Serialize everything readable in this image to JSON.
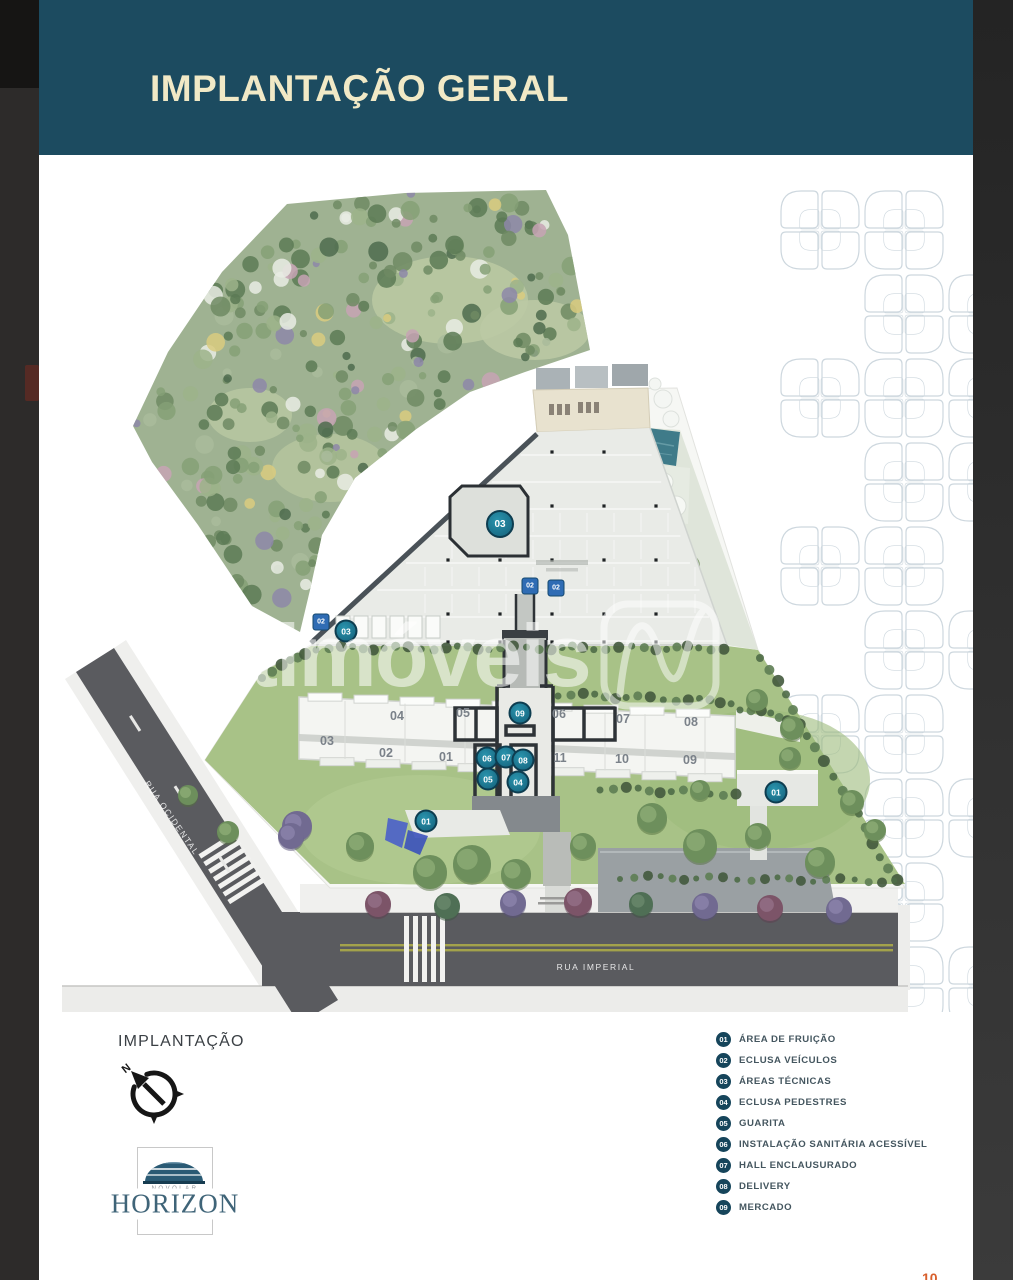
{
  "header": {
    "title": "IMPLANTAÇÃO GERAL"
  },
  "watermark": {
    "text": "netimóveis",
    "logo_icon": "netimoveis-n-mark"
  },
  "plan": {
    "streets": [
      {
        "name": "RUA OCIDENTAL",
        "x": 172,
        "y": 818,
        "angle": 55
      },
      {
        "name": "RUA IMPERIAL",
        "x": 596,
        "y": 967,
        "angle": 0
      }
    ],
    "building_units": [
      {
        "label": "04",
        "x": 397,
        "y": 716
      },
      {
        "label": "05",
        "x": 463,
        "y": 713
      },
      {
        "label": "06",
        "x": 559,
        "y": 714
      },
      {
        "label": "07",
        "x": 623,
        "y": 719
      },
      {
        "label": "08",
        "x": 691,
        "y": 722
      },
      {
        "label": "03",
        "x": 327,
        "y": 741
      },
      {
        "label": "02",
        "x": 386,
        "y": 753
      },
      {
        "label": "01",
        "x": 446,
        "y": 757
      },
      {
        "label": "11",
        "x": 560,
        "y": 758
      },
      {
        "label": "10",
        "x": 622,
        "y": 759
      },
      {
        "label": "09",
        "x": 690,
        "y": 760
      }
    ],
    "markers": [
      {
        "num": "02",
        "x": 321,
        "y": 622,
        "shape": "square"
      },
      {
        "num": "03",
        "x": 346,
        "y": 631,
        "shape": "circle"
      },
      {
        "num": "03",
        "x": 500,
        "y": 524,
        "shape": "circle",
        "large": true
      },
      {
        "num": "02",
        "x": 530,
        "y": 586,
        "shape": "square"
      },
      {
        "num": "02",
        "x": 556,
        "y": 588,
        "shape": "square"
      },
      {
        "num": "09",
        "x": 520,
        "y": 713,
        "shape": "circle"
      },
      {
        "num": "06",
        "x": 487,
        "y": 758,
        "shape": "circle"
      },
      {
        "num": "07",
        "x": 506,
        "y": 757,
        "shape": "circle"
      },
      {
        "num": "08",
        "x": 523,
        "y": 760,
        "shape": "circle"
      },
      {
        "num": "05",
        "x": 488,
        "y": 779,
        "shape": "circle"
      },
      {
        "num": "04",
        "x": 518,
        "y": 782,
        "shape": "circle"
      },
      {
        "num": "01",
        "x": 426,
        "y": 821,
        "shape": "circle"
      },
      {
        "num": "01",
        "x": 776,
        "y": 792,
        "shape": "circle"
      }
    ]
  },
  "legend": {
    "items": [
      {
        "num": "01",
        "label": "ÁREA DE FRUIÇÃO"
      },
      {
        "num": "02",
        "label": "ECLUSA VEÍCULOS"
      },
      {
        "num": "03",
        "label": "ÁREAS TÉCNICAS"
      },
      {
        "num": "04",
        "label": "ECLUSA PEDESTRES"
      },
      {
        "num": "05",
        "label": "GUARITA"
      },
      {
        "num": "06",
        "label": "INSTALAÇÃO SANITÁRIA ACESSÍVEL"
      },
      {
        "num": "07",
        "label": "HALL ENCLAUSURADO"
      },
      {
        "num": "08",
        "label": "DELIVERY"
      },
      {
        "num": "09",
        "label": "MERCADO"
      }
    ]
  },
  "footer": {
    "implantacao_label": "IMPLANTAÇÃO",
    "compass_icon": "north-compass",
    "logo": {
      "brand": "NOVOLAR",
      "name": "HORIZON"
    }
  },
  "page_number": "10",
  "colors": {
    "header_bg": "#1c4b60",
    "title_text": "#f1e9c6",
    "map_badge": "#14607a",
    "legend_badge": "#16455b",
    "page_number": "#d85f2c",
    "road": "#5a5b5f",
    "lawn": "#a8c287"
  }
}
